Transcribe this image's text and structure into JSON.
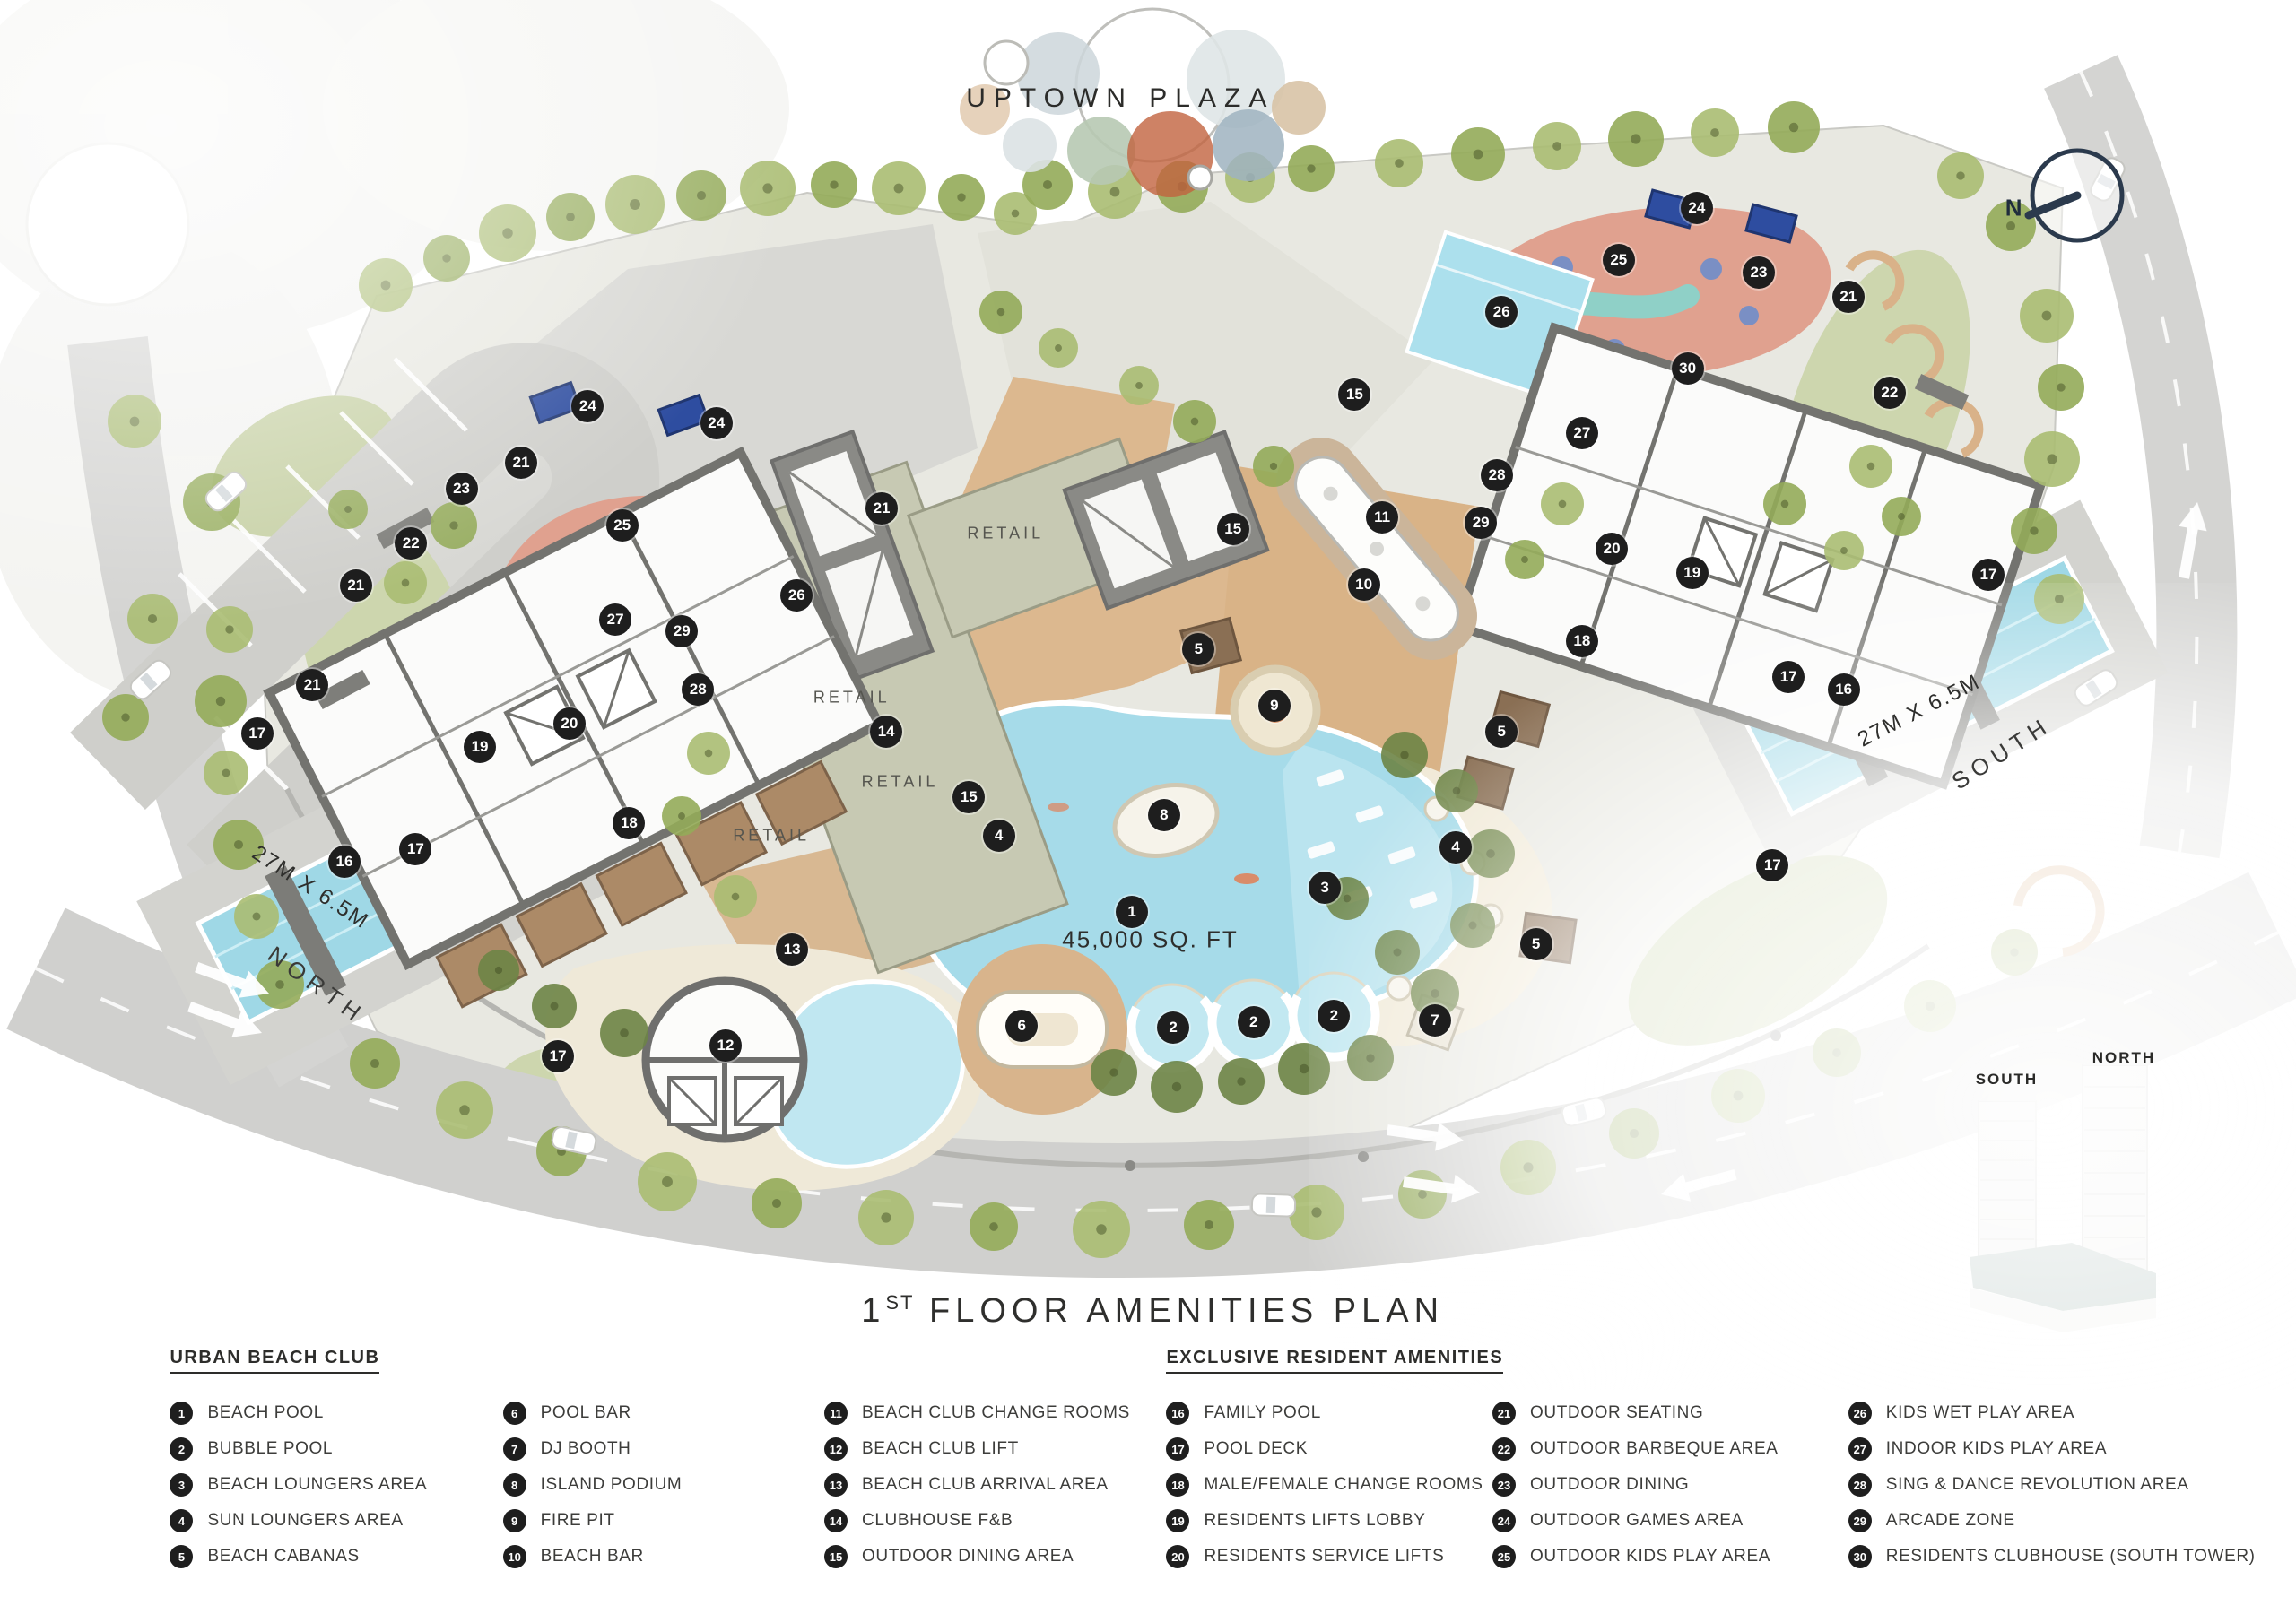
{
  "plan": {
    "plaza_label": "UPTOWN PLAZA",
    "title": {
      "prefix": "1",
      "sup": "ST",
      "rest": " FLOOR AMENITIES PLAN"
    },
    "compass_label": "N",
    "road_labels": {
      "north": "NORTH",
      "south": "SOUTH"
    },
    "pool_dimension_label": "27M X 6.5M",
    "lagoon_area_label": "45,000 SQ. FT",
    "retail_label": "RETAIL",
    "tower_inset": {
      "south": "SOUTH",
      "north": "NORTH"
    }
  },
  "colors": {
    "marker": "#1e1e1e",
    "pool_blue": "#a6dbe9",
    "pool_light": "#c2e8f1",
    "sand": "#f1ead8",
    "deck_wood": "#d9b58d",
    "salmon": "#e0a18f",
    "teal": "#8fd0c7",
    "retail": "#c7c9b3",
    "lawn": "#c3cf9d",
    "road": "#d0d0ce",
    "games_blue": "#2e4da0",
    "podium_teal": "#7f9a93"
  },
  "markers": [
    {
      "n": 24,
      "x": 25.6,
      "y": 25.0
    },
    {
      "n": 24,
      "x": 31.2,
      "y": 26.1
    },
    {
      "n": 21,
      "x": 22.7,
      "y": 28.5
    },
    {
      "n": 23,
      "x": 20.1,
      "y": 30.1
    },
    {
      "n": 22,
      "x": 17.9,
      "y": 33.5
    },
    {
      "n": 25,
      "x": 27.1,
      "y": 32.4
    },
    {
      "n": 21,
      "x": 15.5,
      "y": 36.1
    },
    {
      "n": 26,
      "x": 34.7,
      "y": 36.7
    },
    {
      "n": 21,
      "x": 13.6,
      "y": 42.2
    },
    {
      "n": 27,
      "x": 26.8,
      "y": 38.2
    },
    {
      "n": 29,
      "x": 29.7,
      "y": 38.9
    },
    {
      "n": 28,
      "x": 30.4,
      "y": 42.5
    },
    {
      "n": 17,
      "x": 11.2,
      "y": 45.2
    },
    {
      "n": 20,
      "x": 24.8,
      "y": 44.6
    },
    {
      "n": 19,
      "x": 20.9,
      "y": 46.0
    },
    {
      "n": 14,
      "x": 38.6,
      "y": 45.1
    },
    {
      "n": 21,
      "x": 38.4,
      "y": 31.3
    },
    {
      "n": 18,
      "x": 27.4,
      "y": 50.7
    },
    {
      "n": 16,
      "x": 15.0,
      "y": 53.1
    },
    {
      "n": 17,
      "x": 18.1,
      "y": 52.3
    },
    {
      "n": 15,
      "x": 42.2,
      "y": 49.1
    },
    {
      "n": 4,
      "x": 43.5,
      "y": 51.5
    },
    {
      "n": 13,
      "x": 34.5,
      "y": 58.5
    },
    {
      "n": 17,
      "x": 24.3,
      "y": 65.1
    },
    {
      "n": 12,
      "x": 31.6,
      "y": 64.4
    },
    {
      "n": 6,
      "x": 44.5,
      "y": 63.2
    },
    {
      "n": 2,
      "x": 51.1,
      "y": 63.3
    },
    {
      "n": 2,
      "x": 54.6,
      "y": 63.0
    },
    {
      "n": 2,
      "x": 58.1,
      "y": 62.6
    },
    {
      "n": 8,
      "x": 50.7,
      "y": 50.2
    },
    {
      "n": 1,
      "x": 49.3,
      "y": 56.2
    },
    {
      "n": 9,
      "x": 55.5,
      "y": 43.5
    },
    {
      "n": 5,
      "x": 52.2,
      "y": 40.0
    },
    {
      "n": 15,
      "x": 53.7,
      "y": 32.6
    },
    {
      "n": 15,
      "x": 59.0,
      "y": 24.3
    },
    {
      "n": 10,
      "x": 59.4,
      "y": 36.0
    },
    {
      "n": 11,
      "x": 60.2,
      "y": 31.9
    },
    {
      "n": 3,
      "x": 57.7,
      "y": 54.7
    },
    {
      "n": 4,
      "x": 63.4,
      "y": 52.2
    },
    {
      "n": 5,
      "x": 65.4,
      "y": 45.1
    },
    {
      "n": 5,
      "x": 66.9,
      "y": 58.2
    },
    {
      "n": 7,
      "x": 62.5,
      "y": 62.9
    },
    {
      "n": 28,
      "x": 65.2,
      "y": 29.3
    },
    {
      "n": 29,
      "x": 64.5,
      "y": 32.2
    },
    {
      "n": 27,
      "x": 68.9,
      "y": 26.7
    },
    {
      "n": 26,
      "x": 65.4,
      "y": 19.2
    },
    {
      "n": 25,
      "x": 70.5,
      "y": 16.0
    },
    {
      "n": 24,
      "x": 73.9,
      "y": 12.8
    },
    {
      "n": 23,
      "x": 76.6,
      "y": 16.8
    },
    {
      "n": 21,
      "x": 80.5,
      "y": 18.3
    },
    {
      "n": 22,
      "x": 82.3,
      "y": 24.2
    },
    {
      "n": 30,
      "x": 73.5,
      "y": 22.7
    },
    {
      "n": 20,
      "x": 70.2,
      "y": 33.8
    },
    {
      "n": 19,
      "x": 73.7,
      "y": 35.3
    },
    {
      "n": 18,
      "x": 68.9,
      "y": 39.5
    },
    {
      "n": 17,
      "x": 77.9,
      "y": 41.7
    },
    {
      "n": 16,
      "x": 80.3,
      "y": 42.5
    },
    {
      "n": 17,
      "x": 86.6,
      "y": 35.4
    },
    {
      "n": 17,
      "x": 77.2,
      "y": 53.3
    }
  ],
  "legend": {
    "sections": [
      {
        "title": "URBAN BEACH CLUB",
        "items": [
          {
            "n": 1,
            "label": "BEACH POOL"
          },
          {
            "n": 2,
            "label": "BUBBLE POOL"
          },
          {
            "n": 3,
            "label": "BEACH LOUNGERS AREA"
          },
          {
            "n": 4,
            "label": "SUN LOUNGERS AREA"
          },
          {
            "n": 5,
            "label": "BEACH CABANAS"
          },
          {
            "n": 6,
            "label": "POOL BAR"
          },
          {
            "n": 7,
            "label": "DJ BOOTH"
          },
          {
            "n": 8,
            "label": "ISLAND PODIUM"
          },
          {
            "n": 9,
            "label": "FIRE PIT"
          },
          {
            "n": 10,
            "label": "BEACH BAR"
          },
          {
            "n": 11,
            "label": "BEACH CLUB CHANGE ROOMS"
          },
          {
            "n": 12,
            "label": "BEACH CLUB LIFT"
          },
          {
            "n": 13,
            "label": "BEACH CLUB ARRIVAL AREA"
          },
          {
            "n": 14,
            "label": "CLUBHOUSE F&B"
          },
          {
            "n": 15,
            "label": "OUTDOOR DINING AREA"
          }
        ]
      },
      {
        "title": "EXCLUSIVE RESIDENT AMENITIES",
        "items": [
          {
            "n": 16,
            "label": "FAMILY POOL"
          },
          {
            "n": 17,
            "label": "POOL DECK"
          },
          {
            "n": 18,
            "label": "MALE/FEMALE CHANGE ROOMS"
          },
          {
            "n": 19,
            "label": "RESIDENTS LIFTS LOBBY"
          },
          {
            "n": 20,
            "label": "RESIDENTS SERVICE LIFTS"
          },
          {
            "n": 21,
            "label": "OUTDOOR SEATING"
          },
          {
            "n": 22,
            "label": "OUTDOOR BARBEQUE AREA"
          },
          {
            "n": 23,
            "label": "OUTDOOR DINING"
          },
          {
            "n": 24,
            "label": "OUTDOOR GAMES AREA"
          },
          {
            "n": 25,
            "label": "OUTDOOR KIDS PLAY AREA"
          },
          {
            "n": 26,
            "label": "KIDS WET PLAY AREA"
          },
          {
            "n": 27,
            "label": "INDOOR KIDS PLAY AREA"
          },
          {
            "n": 28,
            "label": "SING & DANCE REVOLUTION AREA"
          },
          {
            "n": 29,
            "label": "ARCADE ZONE"
          },
          {
            "n": 30,
            "label": "RESIDENTS CLUBHOUSE (SOUTH TOWER)"
          }
        ]
      }
    ]
  }
}
